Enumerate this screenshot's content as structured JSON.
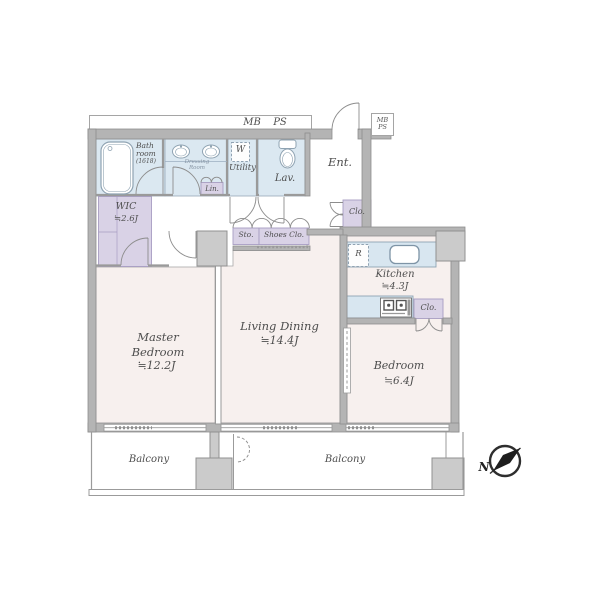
{
  "pipe_spaces": {
    "corridor_mb": "MB",
    "corridor_ps": "PS",
    "corner_mb": "MB",
    "corner_ps": "PS"
  },
  "rooms": {
    "bathroom": {
      "name": "Bath room",
      "size": "(1618)"
    },
    "dressing_room": {
      "name": "Dressing Room"
    },
    "linen": {
      "name": "Lin."
    },
    "washer": {
      "name": "W"
    },
    "utility": {
      "name": "Utility"
    },
    "lavatory": {
      "name": "Lav."
    },
    "entrance": {
      "name": "Ent."
    },
    "entrance_closet": {
      "name": "Clo."
    },
    "storage": {
      "name": "Sto."
    },
    "shoes_closet": {
      "name": "Shoes Clo."
    },
    "wic": {
      "name": "WIC",
      "area": "≒2.6J"
    },
    "refrigerator": {
      "name": "R"
    },
    "kitchen": {
      "name": "Kitchen",
      "area": "≒4.3J"
    },
    "kitchen_closet": {
      "name": "Clo."
    },
    "master_bedroom": {
      "name": "Master Bedroom",
      "area": "≒12.2J"
    },
    "living_dining": {
      "name": "Living Dining",
      "area": "≒14.4J"
    },
    "bedroom": {
      "name": "Bedroom",
      "area": "≒6.4J"
    },
    "balcony_left": {
      "name": "Balcony"
    },
    "balcony_right": {
      "name": "Balcony"
    }
  },
  "compass": {
    "north": "N"
  },
  "colors": {
    "wall": "#b4b4b4",
    "pillar": "#cbcbcb",
    "water_area": "#dbe8f1",
    "closet": "#d9d2e6",
    "room": "#f7f0ee",
    "text": "#4e4e4e"
  }
}
